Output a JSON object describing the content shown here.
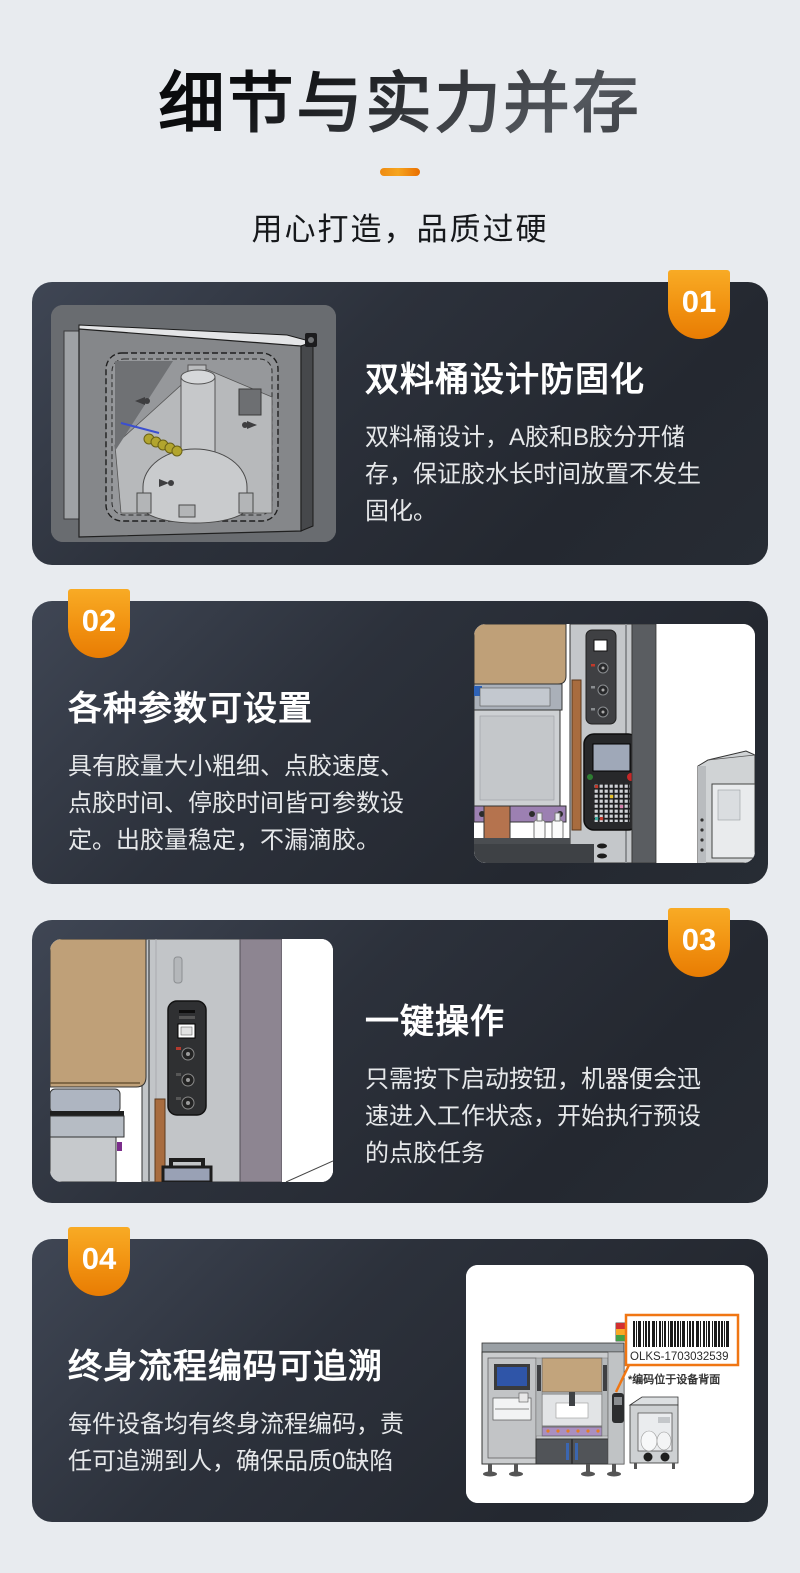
{
  "page": {
    "background": "#e8ebef"
  },
  "header": {
    "title": "细节与实力并存",
    "subtitle": "用心打造，品质过硬"
  },
  "features": [
    {
      "number": "01",
      "title": "双料桶设计防固化",
      "body": "双料桶设计，A胶和B胶分开储\n存，保证胶水长时间放置不发生\n固化。",
      "image": "dual-barrel-cad-view",
      "image_side": "left"
    },
    {
      "number": "02",
      "title": "各种参数可设置",
      "body": "具有胶量大小粗细、点胶速度、\n点胶时间、停胶时间皆可参数设\n定。出胶量稳定，不漏滴胶。",
      "image": "machine-teach-pendant-view",
      "image_side": "right"
    },
    {
      "number": "03",
      "title": "一键操作",
      "body": "只需按下启动按钮，机器便会迅\n速进入工作状态，开始执行预设\n的点胶任务",
      "image": "start-button-panel-view",
      "image_side": "left"
    },
    {
      "number": "04",
      "title": "终身流程编码可追溯",
      "body": "每件设备均有终身流程编码，责\n任可追溯到人，确保品质0缺陷",
      "image": "machine-barcode-traceability-view",
      "image_side": "right",
      "barcode_text": "OLKS-1703032539",
      "barcode_note": "*编码位于设备背面"
    }
  ],
  "colors": {
    "page_bg": "#e8ebef",
    "card_bg_top": "#3f4654",
    "card_bg_bottom": "#23272e",
    "badge_orange_top": "#f8ab25",
    "badge_orange_bottom": "#e87c03",
    "accent_orange": "#f07613",
    "title_black": "#141619",
    "card_text": "#e6e8ea"
  }
}
